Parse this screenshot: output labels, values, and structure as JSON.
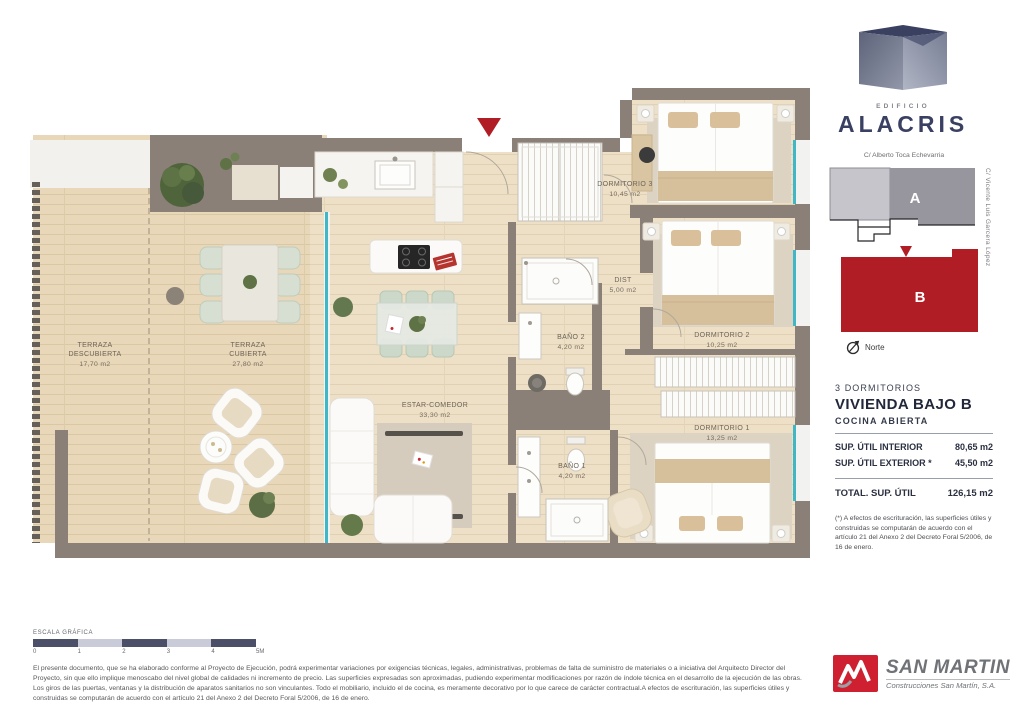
{
  "colors": {
    "accent_red": "#b11d24",
    "navy": "#3a4062",
    "wall_gray": "#8b8077",
    "window_teal": "#3fb7c6",
    "scale_dark": "#4b5068",
    "scale_light": "#c9ccd8",
    "builder_red": "#ce2030"
  },
  "logo": {
    "building_label": "EDIFICIO",
    "building_name": "ALACRIS"
  },
  "site_plan": {
    "street_top": "C/ Alberto Toca Echevarria",
    "street_right": "C/ Vicente Luis Garcera López",
    "block_a": "A",
    "block_b": "B",
    "north_label": "Norte"
  },
  "details": {
    "type": "3 DORMITORIOS",
    "name": "VIVIENDA BAJO B",
    "kitchen": "COCINA ABIERTA",
    "rows": [
      {
        "label": "SUP. ÚTIL INTERIOR",
        "value": "80,65 m2"
      },
      {
        "label": "SUP. ÚTIL EXTERIOR *",
        "value": "45,50 m2"
      }
    ],
    "total": {
      "label": "TOTAL. SUP. ÚTIL",
      "value": "126,15 m2"
    },
    "footnote": "(*) A efectos de escrituración, las superficies útiles y construidas se computarán de acuerdo con el artículo 21 del Anexo 2 del Decreto Foral 5/2006, de 16 de enero."
  },
  "floor_plan": {
    "rooms": [
      {
        "lines": [
          "TERRAZA",
          "DESCUBIERTA"
        ],
        "area": "17,70 m2",
        "x": 70,
        "y": 262
      },
      {
        "lines": [
          "TERRAZA",
          "CUBIERTA"
        ],
        "area": "27,80 m2",
        "x": 223,
        "y": 262
      },
      {
        "lines": [
          "ESTAR-COMEDOR"
        ],
        "area": "33,30 m2",
        "x": 410,
        "y": 322
      },
      {
        "lines": [
          "DORMITORIO 3"
        ],
        "area": "10,45 m2",
        "x": 600,
        "y": 101
      },
      {
        "lines": [
          "DIST"
        ],
        "area": "5,00 m2",
        "x": 598,
        "y": 197
      },
      {
        "lines": [
          "BAÑO 2"
        ],
        "area": "4,20 m2",
        "x": 546,
        "y": 254
      },
      {
        "lines": [
          "DORMITORIO 2"
        ],
        "area": "10,25 m2",
        "x": 697,
        "y": 252
      },
      {
        "lines": [
          "DORMITORIO 1"
        ],
        "area": "13,25 m2",
        "x": 697,
        "y": 345
      },
      {
        "lines": [
          "BAÑO 1"
        ],
        "area": "4,20 m2",
        "x": 547,
        "y": 383
      }
    ]
  },
  "scale_bar": {
    "label": "ESCALA GRÁFICA",
    "ticks": [
      "0",
      "1",
      "2",
      "3",
      "4",
      "5M"
    ],
    "segments": 5
  },
  "disclaimer": "El presente documento, que se ha elaborado conforme al Proyecto de Ejecución, podrá experimentar variaciones por exigencias técnicas, legales, administrativas, problemas de falta de suministro de materiales o a iniciativa del Arquitecto Director del Proyecto, sin que ello implique menoscabo del nivel global de calidades ni incremento de precio. Las superficies expresadas son aproximadas, pudiendo experimentar modificaciones por razón de índole técnica en el desarrollo de la ejecución de las obras. Los giros de las puertas, ventanas y la distribución de aparatos sanitarios no son vinculantes. Todo el mobiliario, incluido el de cocina, es meramente decorativo por lo que carece de carácter contractual.A efectos de escrituración, las superficies útiles y construidas se computarán de acuerdo con el artículo 21 del Anexo 2 del Decreto Foral 5/2006, de 16 de enero.",
  "builder": {
    "name": "SAN MARTIN",
    "subtitle": "Construcciones San Martín, S.A."
  }
}
